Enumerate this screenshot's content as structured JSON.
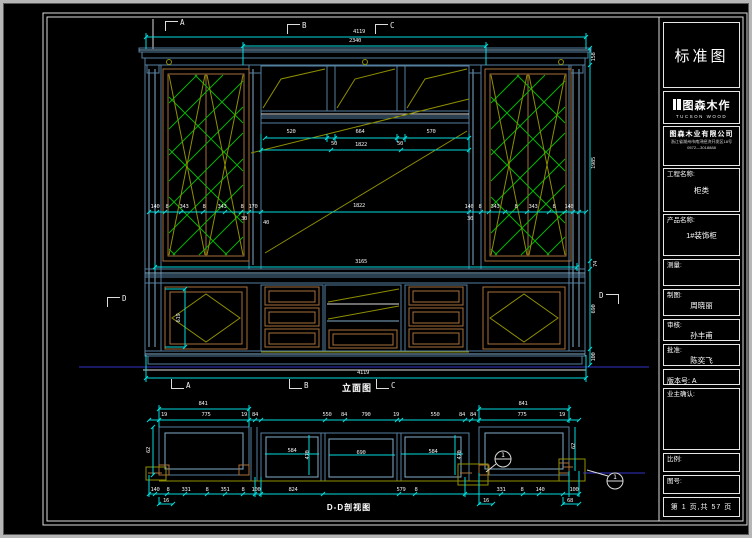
{
  "colors": {
    "dim_cyan": "#00dcdc",
    "frame_blue": "#54809f",
    "wood_tan": "#a9713c",
    "glass_green": "#00b400",
    "swing_olive": "#8f8f00",
    "floor_blue": "#3434c8",
    "sheet_white": "#dcdcdc"
  },
  "title_block": {
    "standard": "标准图",
    "logo_cn": "图森木作",
    "logo_en": "TUCSON WOOD",
    "company": "图森木业有限公司",
    "address1": "浙江省湖州市南浔经济开发区18号",
    "address2": "0572—3018888",
    "project_label": "工程名称:",
    "project_value": "柜类",
    "product_label": "产品名称:",
    "product_value": "1#装饰柜",
    "measure_label": "测量:",
    "draft_label": "制图:",
    "draft_value": "周晓丽",
    "check_label": "审核:",
    "check_value": "孙丰甫",
    "approve_label": "批准:",
    "approve_value": "陈奕飞",
    "version_label": "版本号:",
    "version_value": "A",
    "owner_label": "业主确认:",
    "scale_label": "比例:",
    "drawingno_label": "图号:",
    "page_info": "第 1 页,共 57 页"
  },
  "elevation": {
    "title": "立面图",
    "marker_a": "A",
    "marker_b": "B",
    "marker_c": "C",
    "marker_d": "D",
    "dim_total_top": "4119",
    "dim_inner_top": "2340",
    "dim_520": "520",
    "dim_664": "664",
    "dim_570": "570",
    "dim_50l": "50",
    "dim_1822_shelf": "1822",
    "dim_50r": "50",
    "row_left": [
      "140",
      "8",
      "343",
      "8",
      "343",
      "8",
      "170"
    ],
    "dim_1822_mid": "1822",
    "row_right": [
      "140",
      "8",
      "343",
      "8",
      "343",
      "8",
      "140"
    ],
    "dim_30l": "30",
    "dim_40": "40",
    "dim_30r": "30",
    "dim_3165": "3165",
    "dim_619": "619",
    "dim_158": "158",
    "dim_1985": "1985",
    "dim_74": "74",
    "dim_690": "690",
    "dim_100": "100",
    "dim_total_bottom": "4119"
  },
  "section_view": {
    "title": "D-D剖视图",
    "dim_841_left": "841",
    "dim_841_right": "841",
    "row_top": [
      "19",
      "775",
      "19",
      "84",
      "550",
      "84",
      "790",
      "19",
      "550",
      "84",
      "84",
      "775",
      "19"
    ],
    "dim_62_left": "62",
    "dim_584_left": "584",
    "dim_470_left": "470",
    "dim_690": "690",
    "dim_584_right": "584",
    "dim_470_right": "470",
    "dim_62_right": "62",
    "row_bottom": [
      "140",
      "8",
      "331",
      "8",
      "351",
      "8",
      "100",
      "824",
      "579",
      "8",
      "331",
      "8",
      "140",
      "100"
    ],
    "row_foot": [
      "16",
      "16",
      "68"
    ],
    "balloon_1": "1",
    "balloon_2": "1"
  }
}
